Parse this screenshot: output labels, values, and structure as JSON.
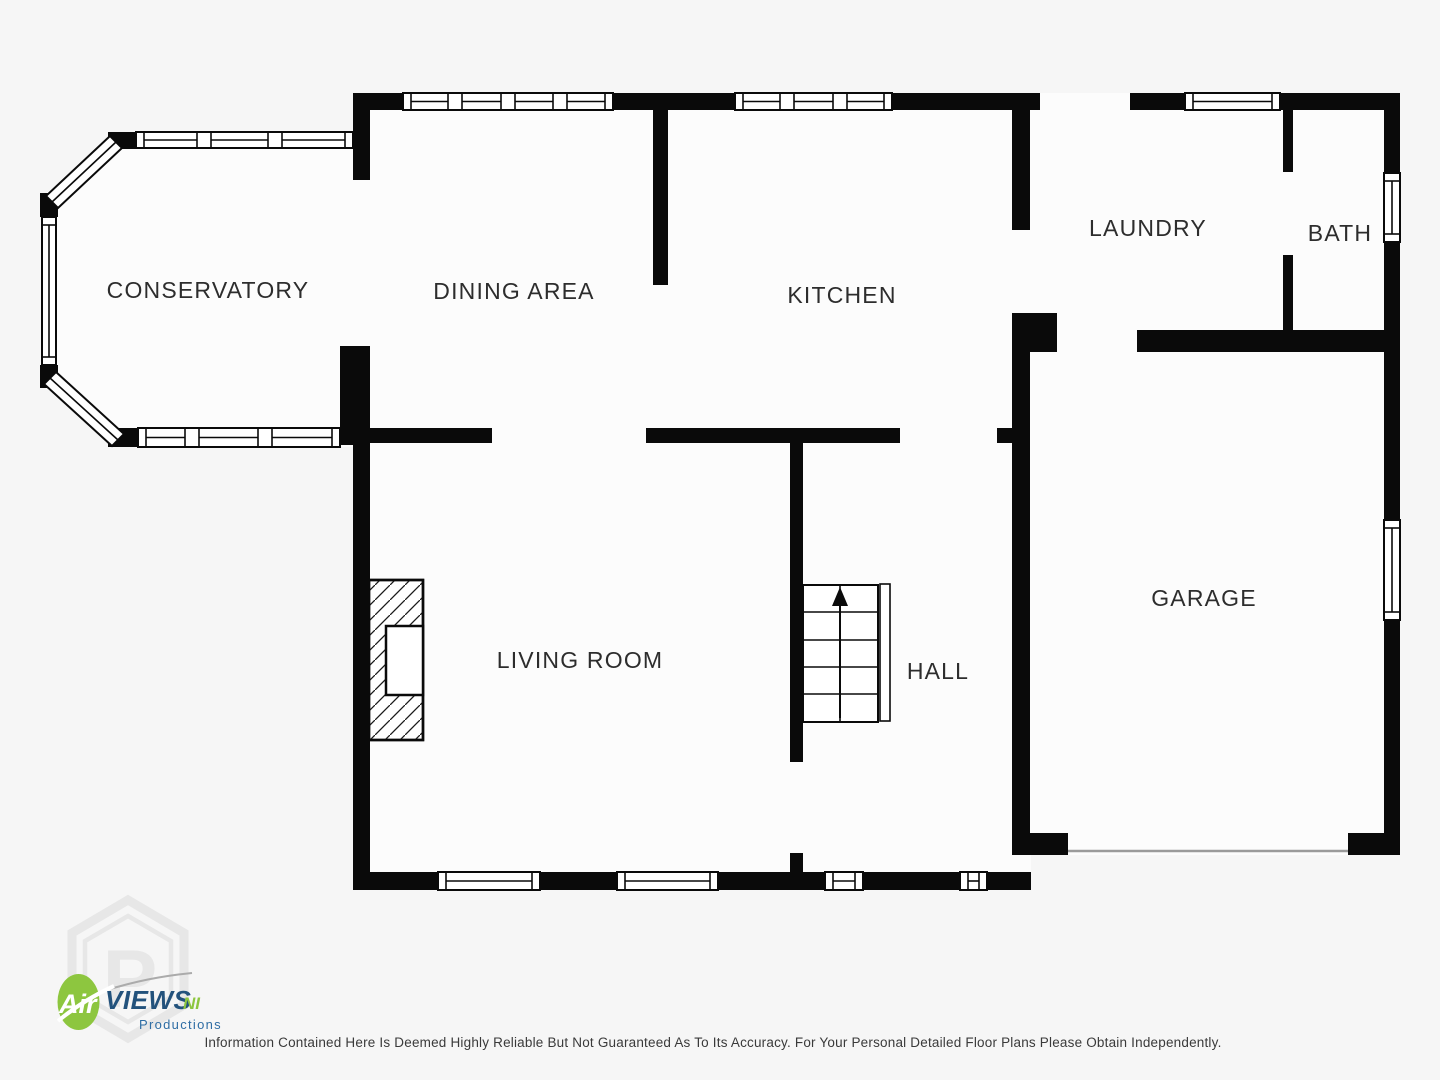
{
  "rooms": {
    "conservatory": "CONSERVATORY",
    "dining": "DINING AREA",
    "kitchen": "KITCHEN",
    "laundry": "LAUNDRY",
    "bath": "BATH",
    "living": "LIVING ROOM",
    "hall": "HALL",
    "garage": "GARAGE"
  },
  "logo": {
    "air": "Air",
    "views": "VIEWS",
    "ni": "NI",
    "productions": "Productions"
  },
  "footer": {
    "disclaimer": "Information Contained Here Is Deemed Highly Reliable But Not Guaranteed As To Its Accuracy. For Your Personal Detailed Floor Plans Please Obtain Independently."
  },
  "colors": {
    "wall": "#0a0a0a",
    "background": "#f6f6f6",
    "floor": "#fcfcfc",
    "label_text": "#2d2d2d",
    "logo_green": "#8dc63f",
    "logo_blue": "#23527c",
    "logo_blue_light": "#2e6da4",
    "watermark_gray": "#e6e6e6"
  }
}
